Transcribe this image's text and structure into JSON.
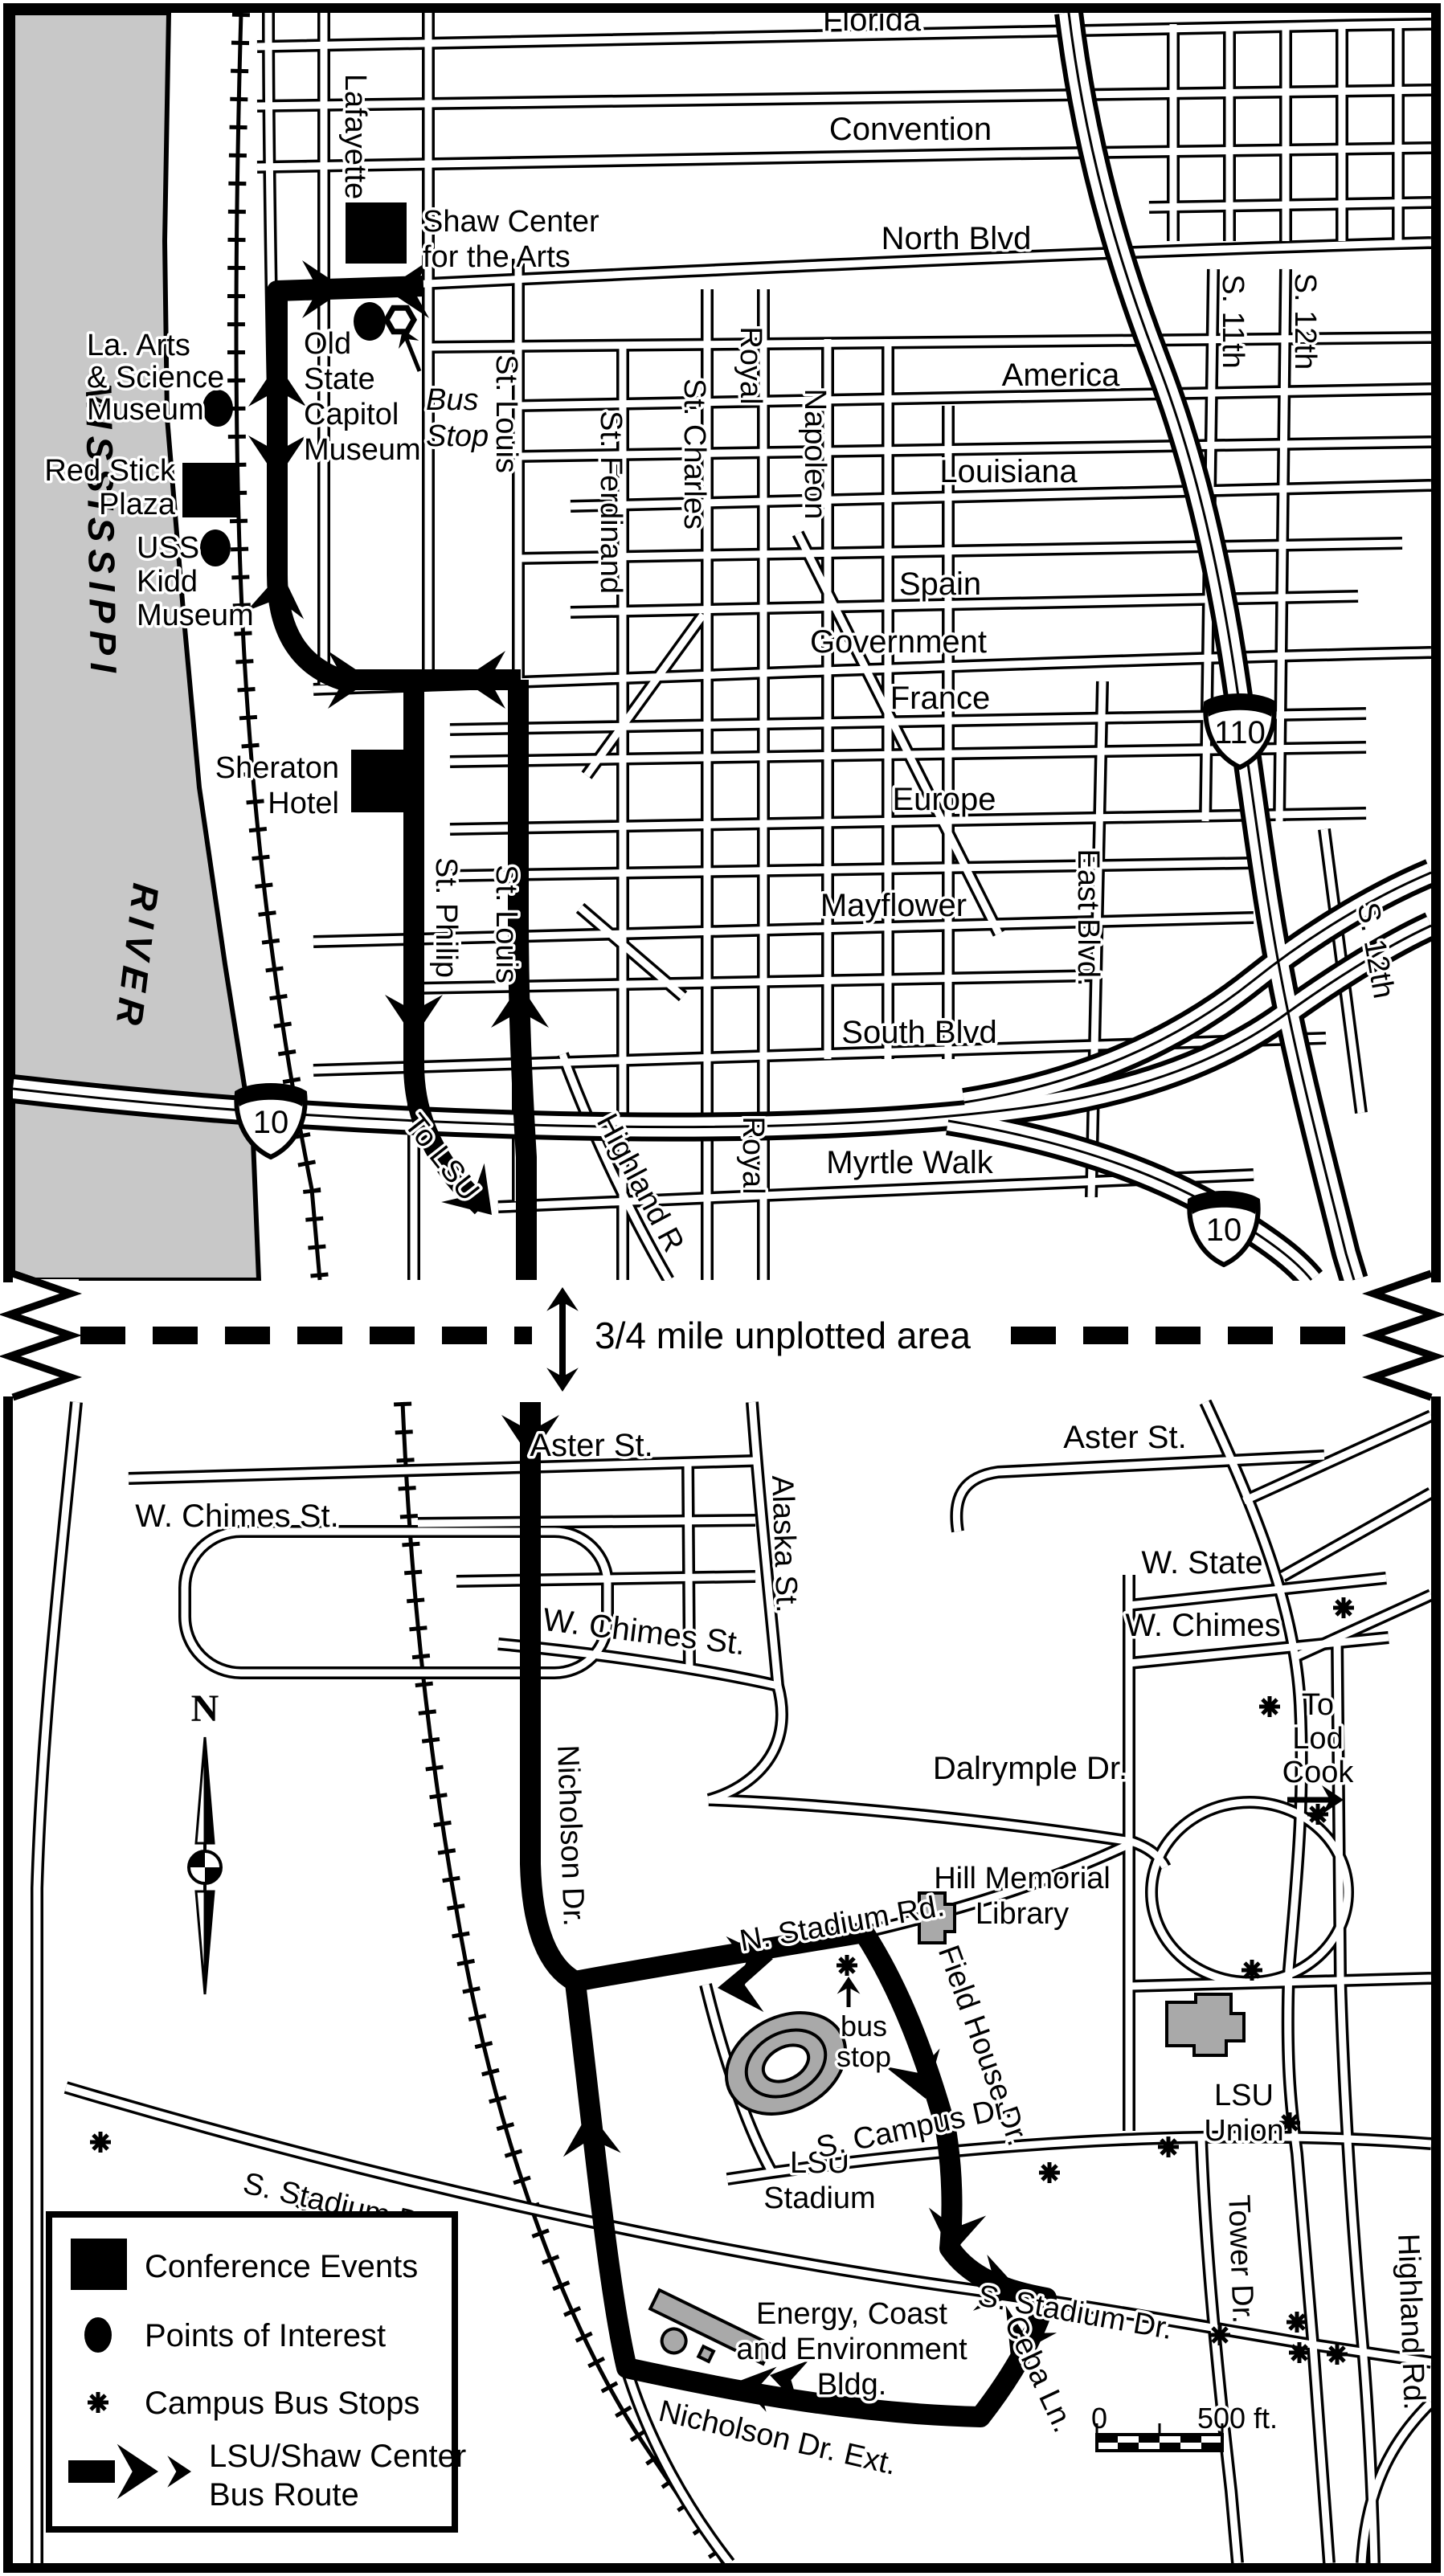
{
  "colors": {
    "river": "#c8c8c8",
    "building": "#a9a9a9",
    "ink": "#000000"
  },
  "river": {
    "word1": "MISSISSIPPI",
    "word2": "RIVER"
  },
  "divider": {
    "label": "3/4 mile unplotted area"
  },
  "shields": {
    "i110": "110",
    "i10_west": "10",
    "i10_south": "10"
  },
  "downtown": {
    "streets": {
      "florida": "Florida",
      "convention": "Convention",
      "north_blvd": "North Blvd",
      "america": "America",
      "louisiana": "Louisiana",
      "spain": "Spain",
      "government": "Government",
      "france": "France",
      "europe": "Europe",
      "mayflower": "Mayflower",
      "south_blvd": "South Blvd",
      "myrtle_walk": "Myrtle Walk",
      "lafayette": "Lafayette",
      "st_louis_upper": "St. Louis",
      "st_louis_lower": "St. Louis",
      "st_ferdinand": "St. Ferdinand",
      "st_charles": "St. Charles",
      "royal_upper": "Royal",
      "royal_lower": "Royal",
      "napoleon": "Napoleon",
      "s_11th": "S. 11th",
      "s_12th_upper": "S. 12th",
      "s_12th_lower": "S. 12th",
      "east_blvd": "East Blvd.",
      "st_philip": "St. Philip",
      "highland": "Highland R",
      "to_lsu": "To LSU"
    },
    "pois": {
      "shaw_center": {
        "lines": [
          "Shaw Center",
          "for the Arts"
        ]
      },
      "old_state_capitol": {
        "lines": [
          "Old",
          "State",
          "Capitol",
          "Museum"
        ]
      },
      "bus_stop": {
        "lines": [
          "Bus",
          "Stop"
        ]
      },
      "la_arts": {
        "lines": [
          "La. Arts",
          "& Science",
          "Museum"
        ]
      },
      "red_stick": {
        "lines": [
          "Red Stick",
          "Plaza"
        ]
      },
      "uss_kidd": {
        "lines": [
          "USS",
          "Kidd",
          "Museum"
        ]
      },
      "sheraton": {
        "lines": [
          "Sheraton",
          "Hotel"
        ]
      }
    }
  },
  "campus": {
    "streets": {
      "aster_left": "Aster St.",
      "aster_right": "Aster St.",
      "w_chimes_loop": "W. Chimes St.",
      "w_chimes_center": "W. Chimes St.",
      "w_state": "W. State",
      "w_chimes_right": "W. Chimes",
      "dalrymple": "Dalrymple Dr.",
      "alaska": "Alaska St.",
      "nicholson": "Nicholson Dr.",
      "n_stadium": "N. Stadium Rd.",
      "field_house": "Field House Dr.",
      "s_campus": "S. Campus Dr.",
      "tower": "Tower Dr.",
      "highland_rd": "Highland Rd.",
      "s_stadium_left": "S. Stadium Dr.",
      "s_stadium_right": "S. Stadium Dr.",
      "ceba": "Ceba Ln.",
      "nicholson_ext": "Nicholson Dr. Ext."
    },
    "places": {
      "to_lod_cook": {
        "lines": [
          "To",
          "Lod",
          "Cook"
        ]
      },
      "hill_memorial": {
        "lines": [
          "Hill Memorial",
          "Library"
        ]
      },
      "lsu_stadium": {
        "lines": [
          "LSU",
          "Stadium"
        ]
      },
      "lsu_union": {
        "lines": [
          "LSU",
          "Union"
        ]
      },
      "energy_bldg": {
        "lines": [
          "Energy, Coast",
          "and Environment",
          "Bldg."
        ]
      },
      "bus_stop": {
        "lines": [
          "bus",
          "stop"
        ]
      }
    },
    "compass": {
      "label": "N"
    },
    "scale": {
      "zero": "0",
      "distance": "500 ft."
    }
  },
  "legend": {
    "conference": "Conference Events",
    "poi": "Points of Interest",
    "stops": "Campus Bus Stops",
    "route_line1": "LSU/Shaw Center",
    "route_line2": "Bus Route"
  }
}
